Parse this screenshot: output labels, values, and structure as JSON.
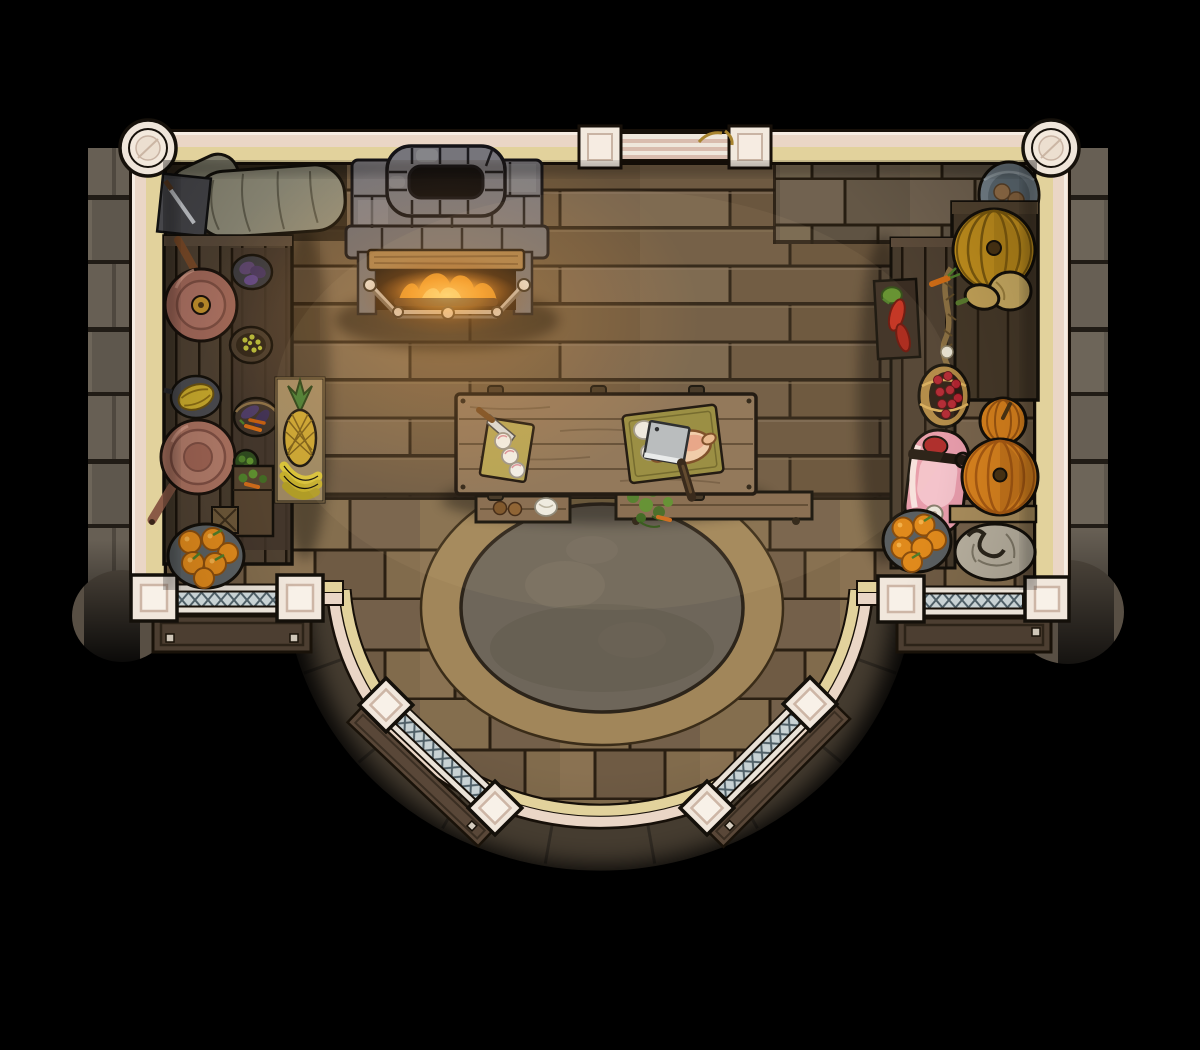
{
  "scene": {
    "description": "Hand-drawn top-down fantasy battle map: a castle kitchen with a stone hearth, food-laden counters, a central prep table and a semicircular stone balcony with lattice railings.",
    "room": {
      "walls": "cream plaster with pink outer and pale-yellow inner stripes",
      "floor_main": "horizontal wood planks",
      "floor_balcony": "tan stone paving around a grey dirt circle",
      "balcony_shape": "semicircular bulge at bottom center"
    },
    "objects": [
      {
        "name": "fireplace",
        "label": "stone hearth with chimney, burning fire and metal fender"
      },
      {
        "name": "grain-sacks",
        "label": "grey grain sacks in north-west corner"
      },
      {
        "name": "slate-board",
        "label": "slate board with knife"
      },
      {
        "name": "left-counter",
        "label": "west wooden counter"
      },
      {
        "name": "copper-pot",
        "label": "copper pot with lid"
      },
      {
        "name": "copper-pan",
        "label": "copper pan with handle"
      },
      {
        "name": "melon-bowl",
        "label": "bowl with melon"
      },
      {
        "name": "eggplant-bowl",
        "label": "bowl of eggplants"
      },
      {
        "name": "olive-basket",
        "label": "basket of olives"
      },
      {
        "name": "veg-basket",
        "label": "basket of eggplants and carrots"
      },
      {
        "name": "herb-bowl",
        "label": "bowl of greens"
      },
      {
        "name": "storage-crate",
        "label": "crate of vegetables"
      },
      {
        "name": "spice-box",
        "label": "small crossed box"
      },
      {
        "name": "orange-bowl-left",
        "label": "bowl of oranges (west)"
      },
      {
        "name": "produce-crate",
        "label": "crate with pineapple and bananas"
      },
      {
        "name": "kitchen-table",
        "label": "central prep table"
      },
      {
        "name": "cutting-board-small",
        "label": "small cutting board with knife and onion slices"
      },
      {
        "name": "cutting-board-large",
        "label": "large cutting board with plucked chicken and cleaver"
      },
      {
        "name": "bench-left",
        "label": "bench with bread and cloth"
      },
      {
        "name": "bench-right",
        "label": "bench with fresh herbs"
      },
      {
        "name": "right-counter",
        "label": "east wooden counter"
      },
      {
        "name": "market-crate",
        "label": "tall crate (east)"
      },
      {
        "name": "yellow-pumpkin",
        "label": "yellow pumpkin"
      },
      {
        "name": "butternut-squash",
        "label": "butternut squash"
      },
      {
        "name": "pepper-box",
        "label": "box of red and green peppers"
      },
      {
        "name": "garlic-rope",
        "label": "hanging rope braid with carrot"
      },
      {
        "name": "berry-basket",
        "label": "basket of red berries"
      },
      {
        "name": "ham",
        "label": "cured ham with bone"
      },
      {
        "name": "pumpkin-small",
        "label": "small orange pumpkin"
      },
      {
        "name": "pumpkin-large",
        "label": "large orange pumpkin"
      },
      {
        "name": "garlic-sack",
        "label": "tied cloth sack"
      },
      {
        "name": "orange-bowl-right",
        "label": "bowl of oranges (east)"
      },
      {
        "name": "harvest-basket",
        "label": "basket with produce (north-east)"
      },
      {
        "name": "dirt-circle",
        "label": "round grey stone platform"
      },
      {
        "name": "balcony-railings",
        "label": "diamond-lattice railings with square and diamond pillars"
      },
      {
        "name": "planters",
        "label": "wooden planter boxes outside railings"
      }
    ],
    "palette": {
      "background": "#000000",
      "wall_pink": "#ead6c6",
      "wall_yellow": "#e2d29c",
      "pillar_cream": "#f1e7dc",
      "wood_floor": "#6e5a42",
      "stone_floor": "#7d674a",
      "exterior_stone": "#655d52",
      "dirt_circle": "#6e665a",
      "fire_orange": "#f59f23",
      "copper": "#a8705e",
      "pumpkin_orange": "#d8821e",
      "pumpkin_yellow": "#c18f1d",
      "squash_tan": "#c9ab62",
      "ham_pink": "#e79cab",
      "orange_fruit": "#e08a1c",
      "lattice_blue": "#c8d2d4",
      "herb_green": "#4e7d2a"
    }
  }
}
